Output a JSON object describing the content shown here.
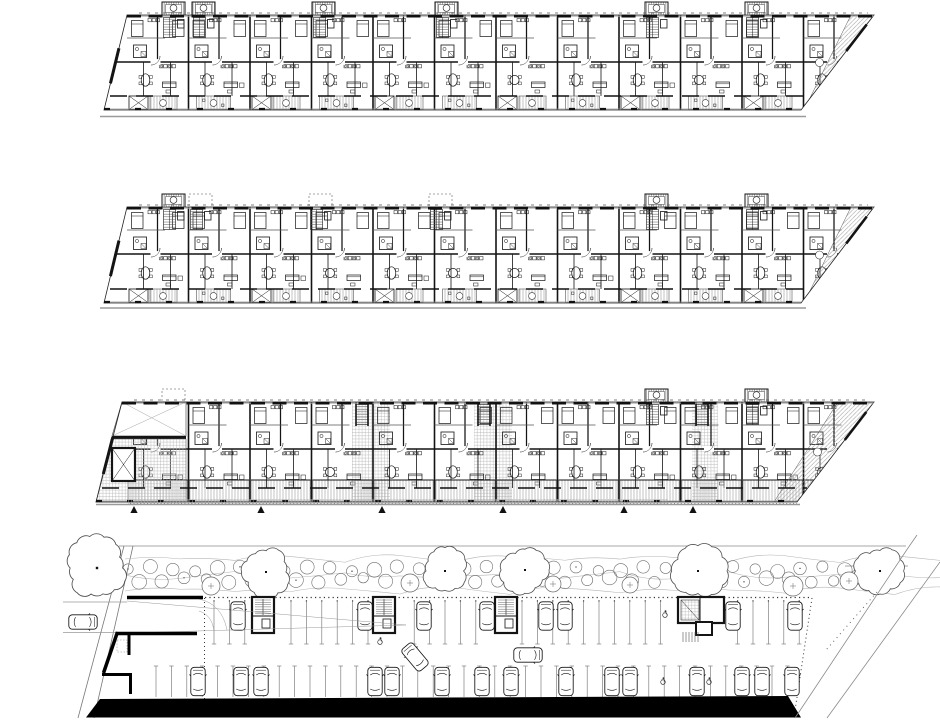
{
  "meta": {
    "title": "Architectural drawing: three stacked apartment floor plans above an underground parking / landscape site plan",
    "drawing_type": "black-and-white CAD plan set",
    "visible_text": "none"
  },
  "canvas": {
    "width": 940,
    "height": 720
  },
  "colors": {
    "paper": "#ffffff",
    "ink": "#141414",
    "wall": "#000000",
    "gray": "#8a8a8a",
    "faint": "#bbbbbb"
  },
  "floor_plans": [
    {
      "id": "upper-floor-plan",
      "outline": {
        "tl": [
          127,
          15
        ],
        "tr": [
          874,
          15
        ],
        "br": [
          801,
          110
        ],
        "bl": [
          104,
          110
        ]
      },
      "bay_start": 127,
      "bay_step": 61.5,
      "bay_count": 12,
      "spine_offset": 47,
      "towers": [
        {
          "x": 162,
          "style": "solid"
        },
        {
          "x": 192,
          "style": "solid"
        },
        {
          "x": 312,
          "style": "solid"
        },
        {
          "x": 435,
          "style": "solid"
        },
        {
          "x": 645,
          "style": "solid"
        },
        {
          "x": 745,
          "style": "solid"
        }
      ],
      "ground_line": {
        "y": 116.5,
        "x1": 100,
        "x2": 806
      },
      "balconies": "alternating",
      "right_terrace": true
    },
    {
      "id": "middle-floor-plan",
      "outline": {
        "tl": [
          127,
          207
        ],
        "tr": [
          874,
          207
        ],
        "br": [
          801,
          303
        ],
        "bl": [
          104,
          303
        ]
      },
      "bay_start": 127,
      "bay_step": 61.5,
      "bay_count": 12,
      "spine_offset": 47,
      "towers": [
        {
          "x": 162,
          "style": "solid"
        },
        {
          "x": 189,
          "style": "dashed"
        },
        {
          "x": 309,
          "style": "dashed"
        },
        {
          "x": 429,
          "style": "dashed"
        },
        {
          "x": 645,
          "style": "solid"
        },
        {
          "x": 745,
          "style": "solid"
        }
      ],
      "ground_line": {
        "y": 308,
        "x1": 100,
        "x2": 806
      },
      "balconies": "alternating",
      "right_terrace": true
    },
    {
      "id": "ground-floor-plan",
      "outline": {
        "tl": [
          122,
          402
        ],
        "tr": [
          874,
          402
        ],
        "br": [
          797,
          502
        ],
        "bl": [
          96,
          502
        ]
      },
      "bay_start": 127,
      "bay_step": 61.5,
      "bay_count": 12,
      "spine_offset": 47,
      "towers": [
        {
          "x": 162,
          "style": "dashed"
        },
        {
          "x": 645,
          "style": "solid"
        },
        {
          "x": 745,
          "style": "solid"
        }
      ],
      "lobbies": [
        {
          "x": 352,
          "w": 38
        },
        {
          "x": 474,
          "w": 38
        },
        {
          "x": 692,
          "w": 26
        }
      ],
      "plaza": true,
      "ground_line": {
        "y": 504.5,
        "x1": 96,
        "x2": 800
      },
      "balconies": "terraces",
      "right_terrace": true,
      "entrance_markers": {
        "y": 506,
        "xs": [
          134,
          261,
          382,
          503,
          624,
          693
        ]
      }
    }
  ],
  "site_plan": {
    "boundary_lines": [
      [
        119,
        546,
        906,
        546
      ],
      [
        845,
        566,
        908,
        566
      ]
    ],
    "left_road": {
      "edges": [
        [
          124,
          546,
          78,
          718
        ],
        [
          133,
          546,
          94,
          718
        ]
      ],
      "cross_lines": [
        [
          63,
          602,
          127,
          602
        ],
        [
          63,
          632.5,
          117,
          632.5
        ]
      ],
      "car": {
        "cx": 83,
        "cy": 622,
        "rot": 90
      }
    },
    "big_tree": {
      "cx": 97,
      "cy": 568,
      "r": 29
    },
    "hedge": {
      "x1": 128,
      "x2": 898,
      "rows": [
        569,
        580
      ]
    },
    "large_trees": [
      [
        266,
        572,
        23
      ],
      [
        445,
        571,
        21
      ],
      [
        525,
        570,
        22
      ],
      [
        698,
        571,
        26
      ],
      [
        880,
        571,
        23
      ]
    ],
    "circle_trees": [
      [
        211,
        586,
        9
      ],
      [
        410,
        583,
        9
      ],
      [
        553,
        584,
        8
      ],
      [
        630,
        585,
        8
      ],
      [
        793,
        586,
        10
      ],
      [
        849,
        581,
        9
      ]
    ],
    "garage": {
      "dotted_top": {
        "y": 597.5,
        "x1": 205,
        "x2": 812
      },
      "dotted_left_x": 204.5,
      "dotted_right": [
        812,
        598,
        794,
        717
      ],
      "extra_dotted": [
        877,
        592,
        826,
        650
      ],
      "top_stalls": {
        "y1": 600,
        "y2": 644,
        "x1": 214,
        "x2": 808,
        "step": 15.4
      },
      "bottom_stalls": {
        "y1": 666,
        "y2": 697,
        "x1": 156,
        "x2": 795,
        "step": 15.4
      },
      "cores": [
        {
          "x": 252,
          "w": 22
        },
        {
          "x": 373,
          "w": 22
        },
        {
          "x": 495,
          "w": 22
        },
        {
          "x": 678,
          "w": 46,
          "large": true
        }
      ],
      "cars_top": [
        238,
        365,
        424,
        487,
        546,
        565,
        733,
        795
      ],
      "cars_bottom": [
        198,
        241,
        261,
        375,
        392,
        442,
        482,
        511,
        566,
        612,
        630,
        697,
        742,
        762,
        792
      ],
      "moving_cars": [
        {
          "cx": 415,
          "cy": 657,
          "rot": -40
        },
        {
          "cx": 528,
          "cy": 655,
          "rot": 90
        }
      ],
      "accessible": [
        [
          665,
          614
        ],
        [
          380,
          641
        ],
        [
          663,
          681
        ],
        [
          709,
          681
        ]
      ],
      "black_band": [
        [
          100,
          699
        ],
        [
          788,
          696
        ],
        [
          801,
          717.5
        ],
        [
          86,
          717.5
        ]
      ],
      "ramp_lines": [
        [
          127,
          601,
          406,
          625
        ],
        [
          127,
          633,
          406,
          625
        ]
      ]
    },
    "right_roads": [
      [
        908,
        548,
        795,
        718
      ],
      [
        940,
        562,
        827,
        718
      ],
      [
        917,
        535,
        908,
        548
      ]
    ]
  }
}
